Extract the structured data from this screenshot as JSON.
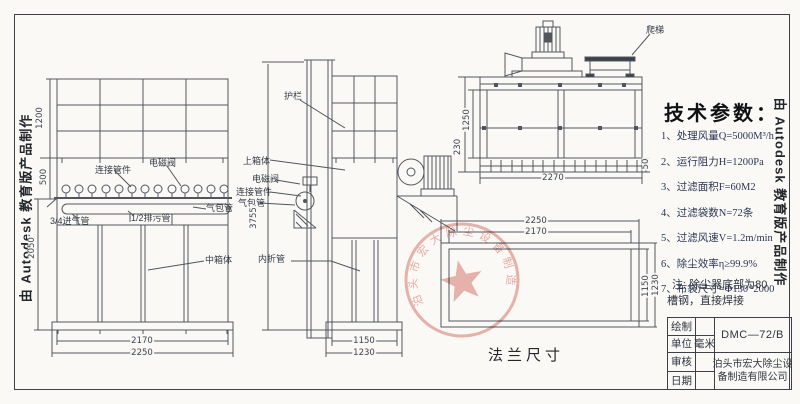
{
  "watermark_text": "由 Autodesk 教育版产品制作",
  "front_view": {
    "labels": {
      "connector": "连接管件",
      "solenoid": "电磁阀",
      "air_bag": "气包管",
      "drain_pipe": "1/2排污管",
      "inlet_pipe": "3/4进气管",
      "middle_box": "中箱体"
    },
    "dims": {
      "h_top": "1200",
      "h_mid": "500",
      "h_bottom": "2050",
      "w_inner": "2170",
      "w_outer": "2250"
    }
  },
  "side_view": {
    "labels": {
      "guardrail": "护栏",
      "upper_box": "上箱体",
      "solenoid": "电磁阀",
      "connector": "连接管件",
      "air_bag": "气包管",
      "inner_pipe": "内折管"
    },
    "dims": {
      "total_h": "3755",
      "w_inner": "1150",
      "w_outer": "1230"
    }
  },
  "plan_view": {
    "labels": {
      "ladder": "爬梯"
    },
    "dims": {
      "width": "2270",
      "d_inner": "1250",
      "d_edge": "230",
      "d_small": "50"
    }
  },
  "flange_view": {
    "title": "法兰尺寸",
    "dims": {
      "w_outer": "2250",
      "w_inner": "2170",
      "h_inner": "1150",
      "h_outer": "1230"
    }
  },
  "tech_specs": {
    "title": "技术参数：",
    "items": [
      "1、处理风量Q=5000M³/h",
      "2、运行阻力H=1200Pa",
      "3、过滤面积F=60M2",
      "4、过滤袋数N=72条",
      "5、过滤风速V=1.2m/min",
      "6、除尘效率η≥99.9%",
      "7、布袋尺寸=Φ130*2000"
    ]
  },
  "note": {
    "line1": "注: 除尘器底部为80",
    "line2": "槽钢，直接焊接"
  },
  "title_block": {
    "rows": [
      {
        "label": "绘制",
        "value": ""
      },
      {
        "label": "单位",
        "value": "毫米"
      },
      {
        "label": "审核",
        "value": ""
      },
      {
        "label": "日期",
        "value": ""
      }
    ],
    "model": "DMC—72/B",
    "company_line1": "泊头市宏大除尘设",
    "company_line2": "备制造有限公司"
  },
  "stamp_text": "泊头市宏大除尘设备制造有限公司"
}
